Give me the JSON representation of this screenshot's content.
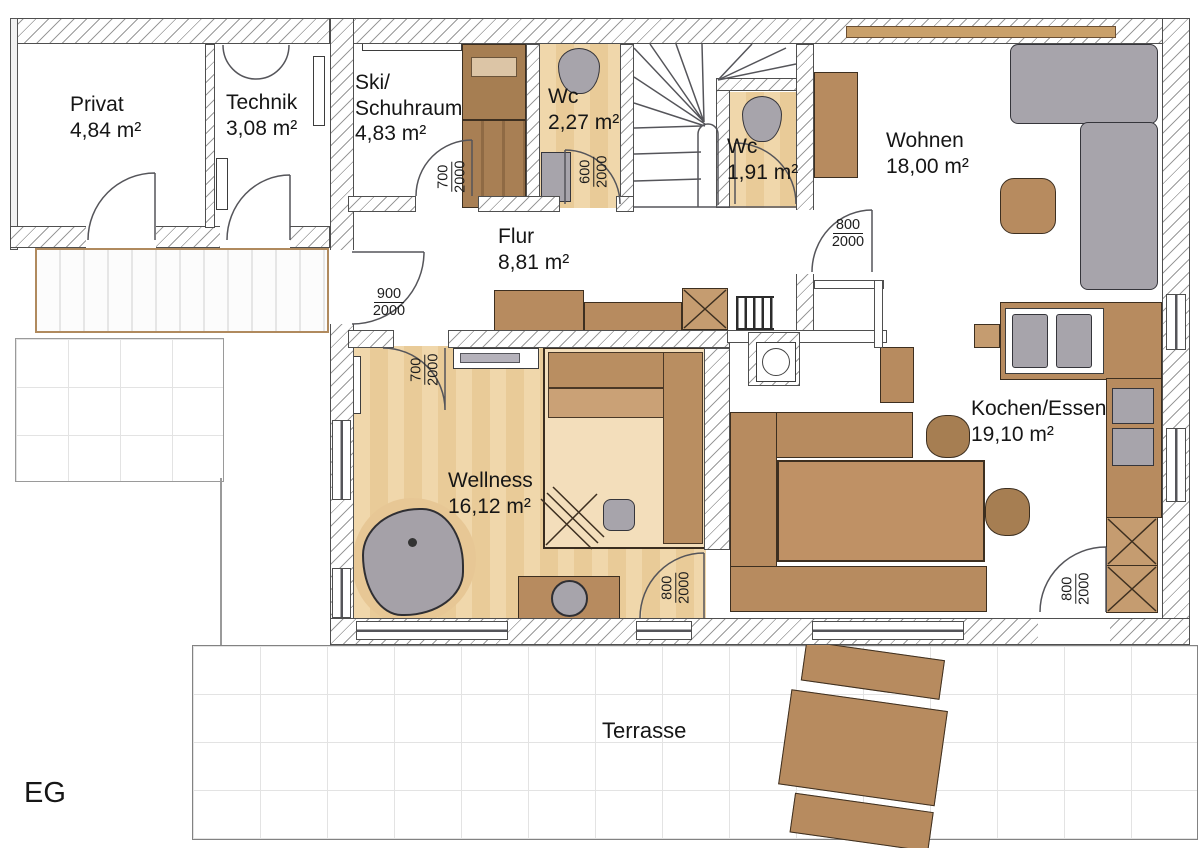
{
  "plan": {
    "floor_label": "EG",
    "rooms": {
      "privat": {
        "name": "Privat",
        "area": "4,84 m²"
      },
      "technik": {
        "name": "Technik",
        "area": "3,08 m²"
      },
      "ski": {
        "name_line1": "Ski/",
        "name_line2": "Schuhraum",
        "area": "4,83 m²"
      },
      "wc": {
        "name": "Wc",
        "area": "2,27 m²"
      },
      "wc_klein": {
        "name": "Wc",
        "area": "1,91 m²"
      },
      "wohnen": {
        "name": "Wohnen",
        "area": "18,00 m²"
      },
      "flur": {
        "name": "Flur",
        "area": "8,81 m²"
      },
      "wellness": {
        "name": "Wellness",
        "area": "16,12 m²"
      },
      "kochen_essen": {
        "name": "Kochen/Essen",
        "area": "19,10 m²"
      },
      "terrasse": {
        "name": "Terrasse"
      }
    },
    "door_dimensions": {
      "ski_door": {
        "w": "700",
        "h": "2000"
      },
      "wc_door": {
        "w": "600",
        "h": "2000"
      },
      "wohnen_door": {
        "w": "800",
        "h": "2000"
      },
      "entry_door": {
        "w": "900",
        "h": "2000"
      },
      "wellness_door": {
        "w": "700",
        "h": "2000"
      },
      "wellness_kochen_door": {
        "w": "800",
        "h": "2000"
      },
      "terrace_door": {
        "w": "800",
        "h": "2000"
      }
    },
    "colors": {
      "floor_wash": "#edd2a4",
      "wood_furniture": "#b78b5f",
      "upholstery_gray": "#a7a4ab",
      "wall_outline": "#4f4f4f"
    }
  }
}
